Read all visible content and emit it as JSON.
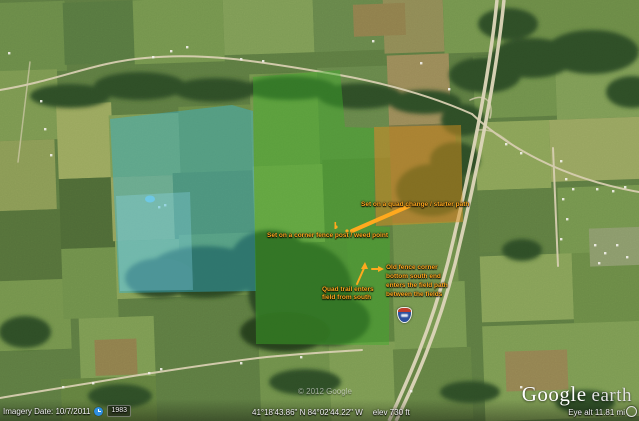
{
  "app": "Google Earth",
  "map": {
    "annotation_color": "#ffa91e",
    "annotations": {
      "quad_change": "Set on a quad change / starter path",
      "fence_post": "Set on a corner fence post / weed point",
      "quad_trail": {
        "line1": "Quad trail enters",
        "line2": "field from south"
      },
      "old_fence": {
        "line1": "Old fence corner",
        "line2": "bottom south end",
        "line3": "enters the field path",
        "line4": "between the fields"
      }
    },
    "overlays": {
      "west": {
        "name": "west-blue-zone",
        "color": "#35b4d6",
        "light_color": "#90dbf2"
      },
      "center": {
        "name": "center-green-zone",
        "color": "#3fae2a"
      },
      "east": {
        "name": "east-orange-zone",
        "color": "#d78f1e"
      }
    },
    "shield": {
      "type": "interstate",
      "top_color": "#bf3b2b",
      "bottom_color": "#2c4f9e"
    }
  },
  "status_bar": {
    "imagery_date": "Imagery Date: 10/7/2011",
    "history_icon": "clock-icon",
    "history_year": "1983",
    "coordinates": "41°18'43.86\" N   84°02'44.22\" W",
    "elevation": "elev  730 ft",
    "eye_altitude": "Eye alt  11.81 mi",
    "watermark": "© 2012 Google"
  },
  "logo": {
    "google": "Google",
    "earth": "earth"
  }
}
